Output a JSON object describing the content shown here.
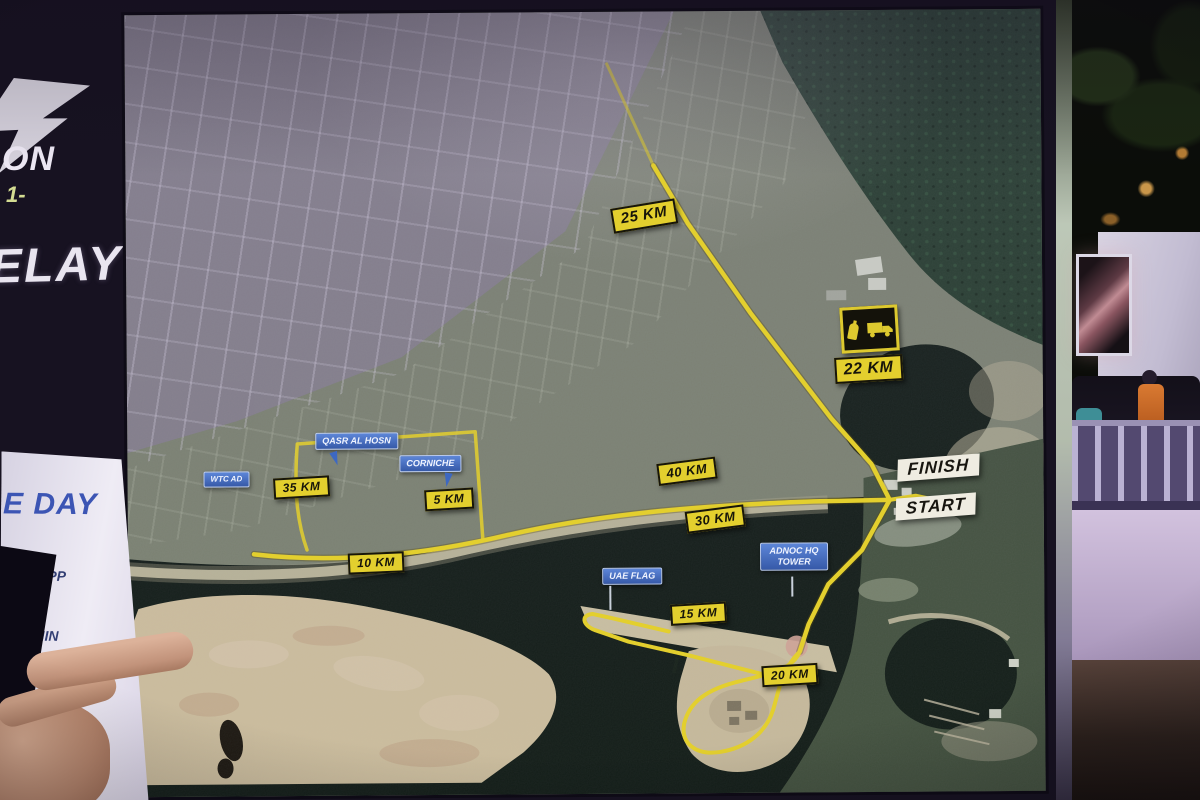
{
  "photo": {
    "board": {
      "logo": {
        "line1": "ON",
        "line2": "1-"
      },
      "relay_text": "ELAY",
      "info_poster": {
        "heading": "E DAY",
        "lines": [
          "SH APP",
          "THIN",
          "E TIME"
        ]
      }
    },
    "map": {
      "km": [
        {
          "label": "25 KM"
        },
        {
          "label": "22 KM"
        },
        {
          "label": "40 KM"
        },
        {
          "label": "30 KM"
        },
        {
          "label": "35 KM"
        },
        {
          "label": "5 KM"
        },
        {
          "label": "10 KM"
        },
        {
          "label": "15 KM"
        },
        {
          "label": "20 KM"
        }
      ],
      "race": [
        {
          "label": "FINISH"
        },
        {
          "label": "START"
        }
      ],
      "landmarks": [
        {
          "lines": [
            "WTC AD"
          ]
        },
        {
          "lines": [
            "QASR AL HOSN"
          ]
        },
        {
          "lines": [
            "CORNICHE"
          ]
        },
        {
          "lines": [
            "UAE FLAG"
          ]
        },
        {
          "lines": [
            "ADNOC HQ",
            "TOWER"
          ]
        }
      ],
      "aid_station_icons": [
        "bottle-icon",
        "truck-icon"
      ],
      "colors": {
        "route_yellow": "#e3cf2e",
        "marker_blue": "#3d68c2",
        "badge_white": "#efece1",
        "water_dark": "#0c1611",
        "sand": "#d5c4a2"
      }
    }
  }
}
